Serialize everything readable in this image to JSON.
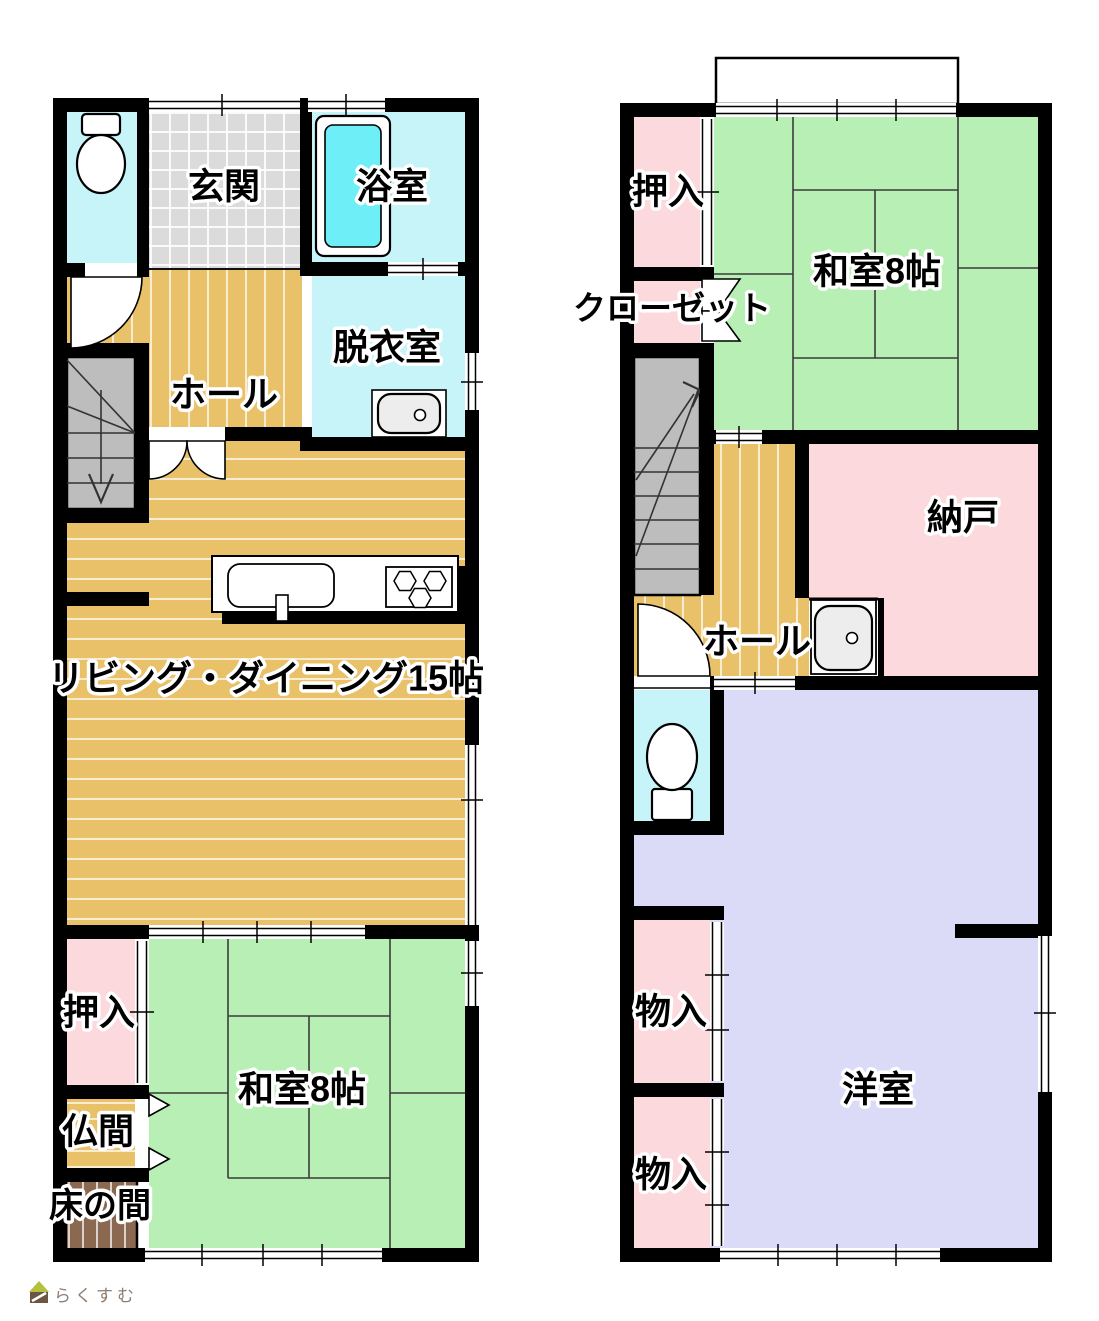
{
  "floor1": {
    "labels": {
      "genkan": "玄関",
      "bathroom": "浴室",
      "dressing_room": "脱衣室",
      "hall": "ホール",
      "living_dining": "リビング・ダイニング15帖",
      "oshiire": "押入",
      "washitsu": "和室8帖",
      "butsuma": "仏間",
      "tokonoma": "床の間"
    }
  },
  "floor2": {
    "labels": {
      "oshiire": "押入",
      "washitsu": "和室8帖",
      "closet": "クローゼット",
      "nando": "納戸",
      "hall": "ホール",
      "monoire_upper": "物入",
      "monoire_lower": "物入",
      "youshitsu": "洋室"
    }
  },
  "watermark": {
    "brand": "らくすむ"
  },
  "colors": {
    "wood": "#e9c169",
    "tatami": "#b7efb4",
    "pink": "#fcd9dc",
    "lavender": "#dcdbf7",
    "cyan": "#c7f4f9",
    "tub": "#6eeef6",
    "tile": "#dbdbdb",
    "stairs": "#bdbdbd",
    "tokonoma": "#8a6950",
    "wall": "#000000",
    "logo_roof": "#b3c13d",
    "logo_body": "#6b5645"
  }
}
